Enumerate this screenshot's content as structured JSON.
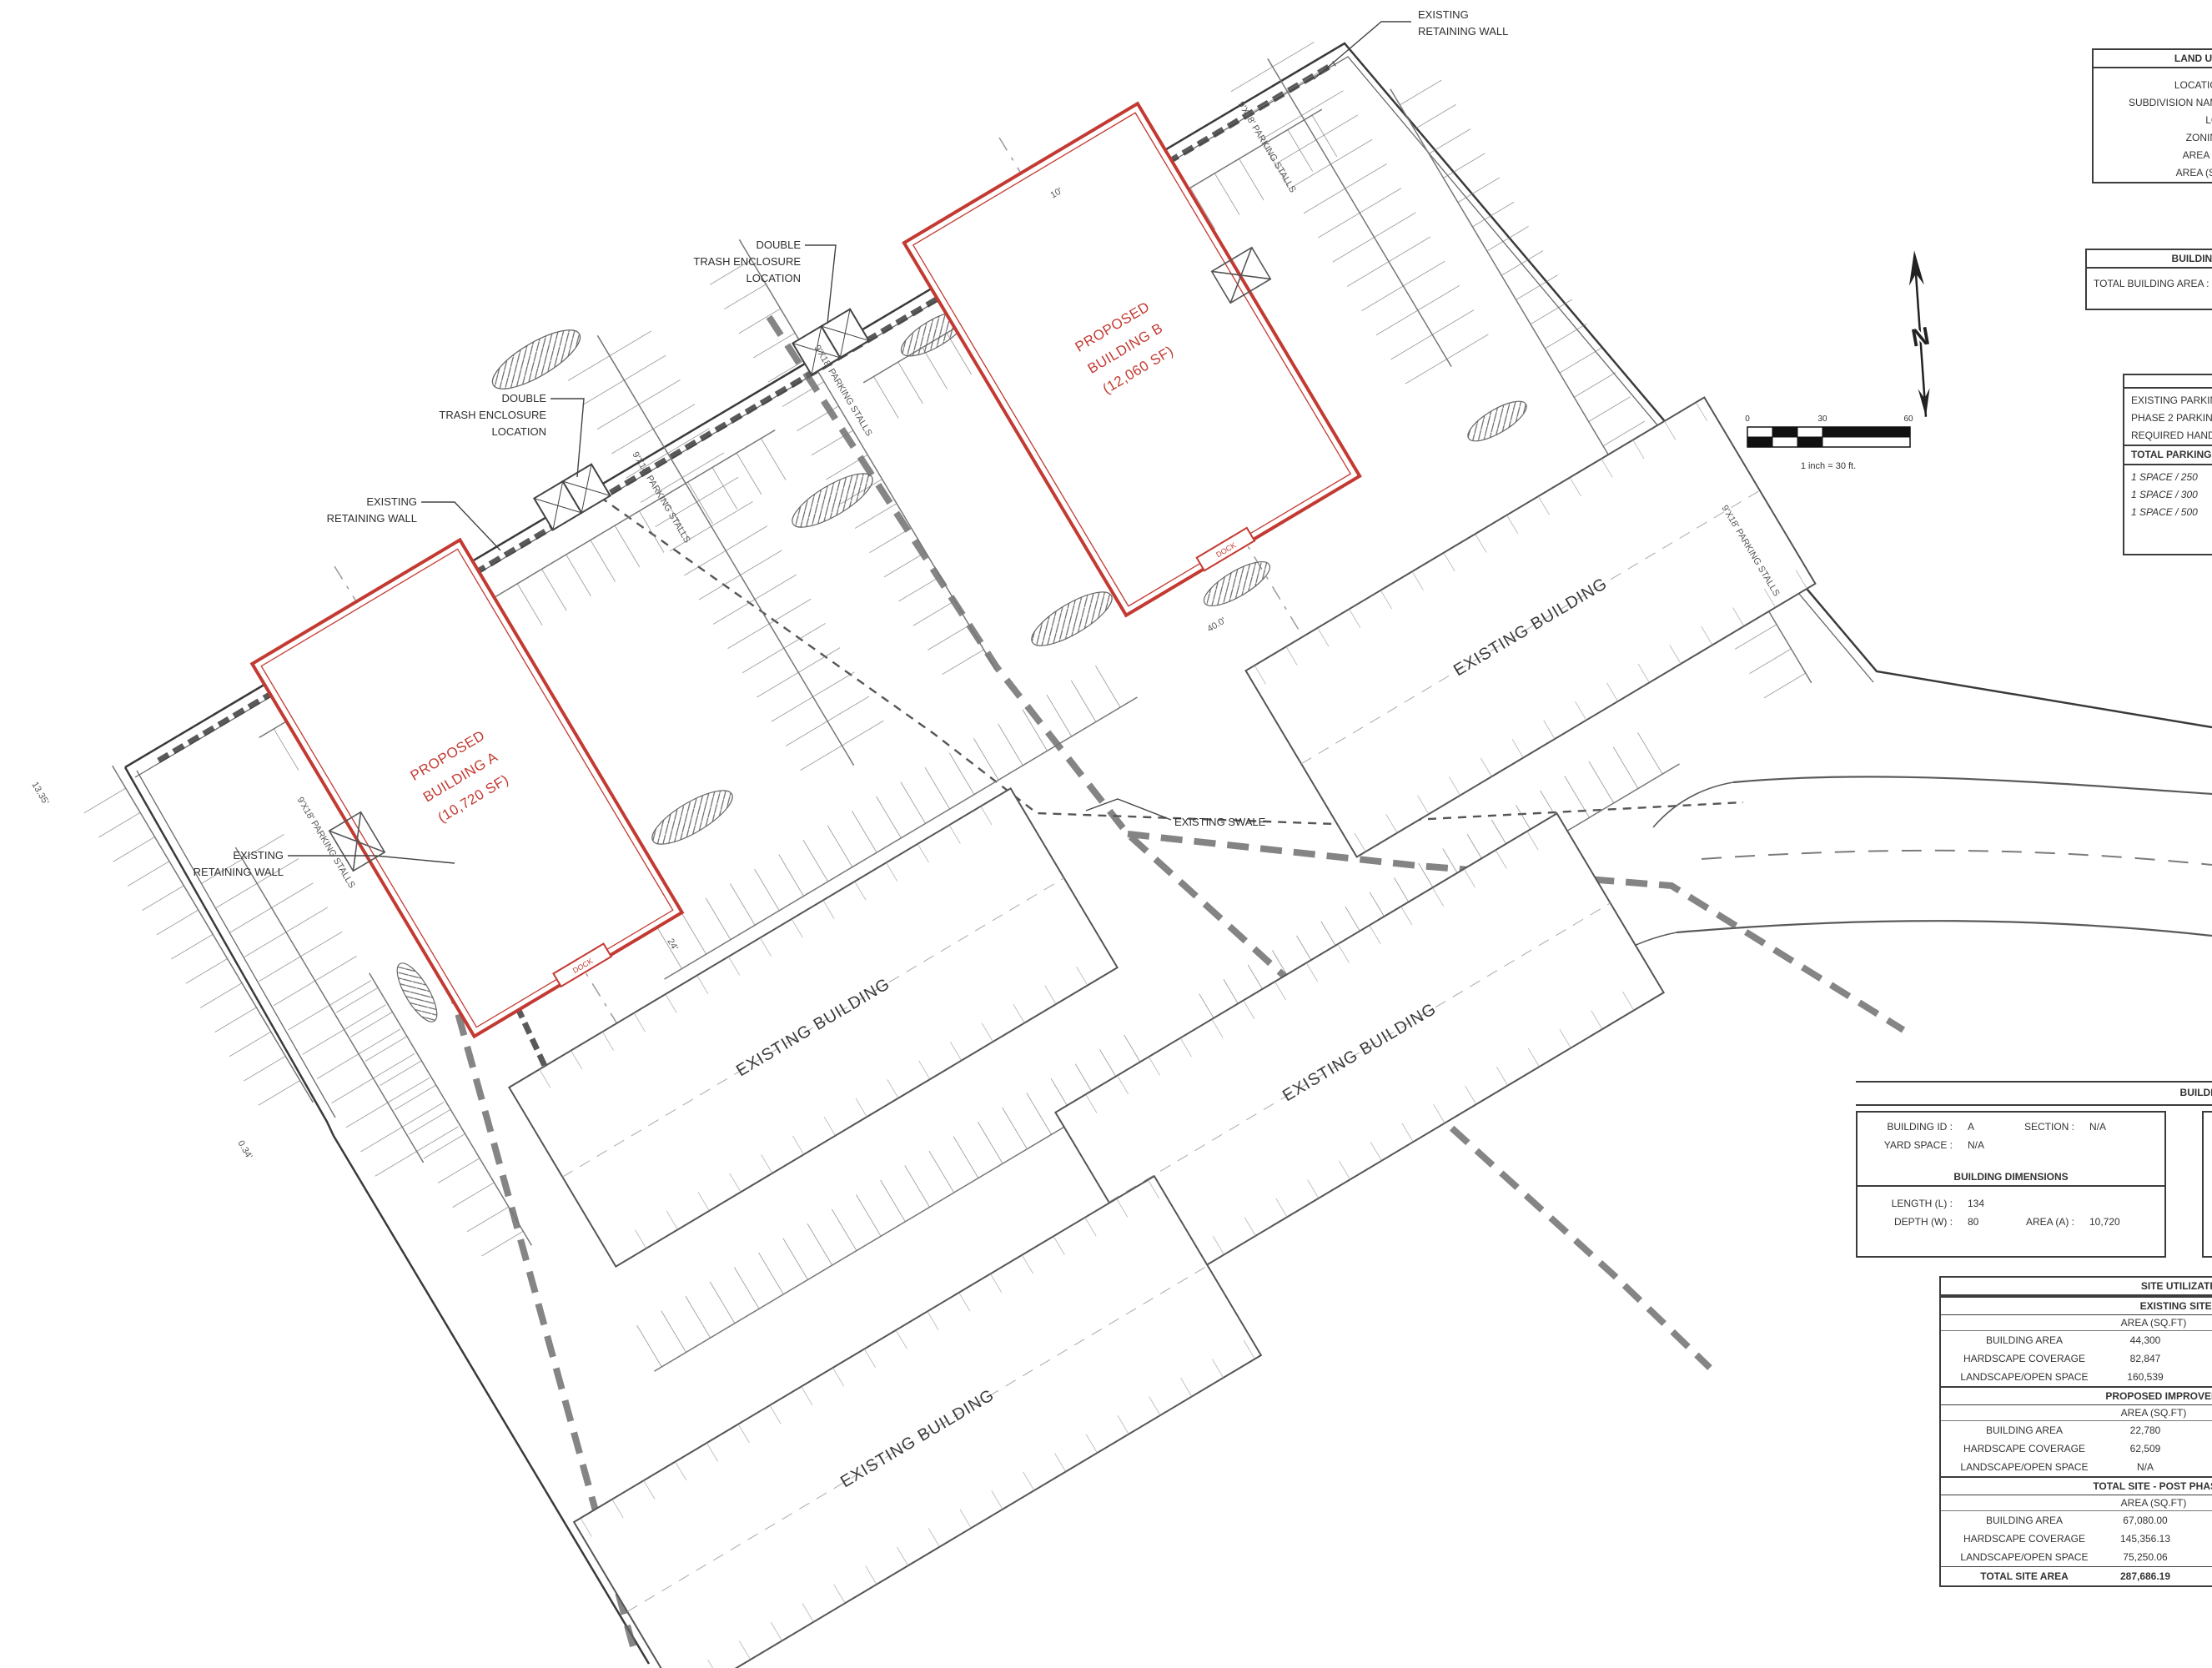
{
  "colors": {
    "red": "#c33a32",
    "ink": "#333333",
    "line": "#5a5a5a"
  },
  "north": {
    "label": "N"
  },
  "scale_bar": {
    "ticks": [
      "0",
      "30",
      "60"
    ],
    "caption": "1 inch = 30 ft."
  },
  "plan": {
    "existing_building": "EXISTING BUILDING",
    "swale": "EXISTING SWALE",
    "retaining_wall_line1": "EXISTING",
    "retaining_wall_line2": "RETAINING WALL",
    "trash_line1": "DOUBLE",
    "trash_line2": "TRASH ENCLOSURE",
    "trash_line3": "LOCATION",
    "building_a_line1": "PROPOSED",
    "building_a_line2": "BUILDING A",
    "building_a_line3": "(10,720 SF)",
    "building_b_line1": "PROPOSED",
    "building_b_line2": "BUILDING B",
    "building_b_line3": "(12,060 SF)",
    "stalls": "9'X18' PARKING STALLS",
    "dock": "DOCK",
    "dims": {
      "d10": "10'",
      "d40": "40.0'",
      "d24": "24'",
      "d1335": "13.35'",
      "d034": "0.34'"
    }
  },
  "tables": {
    "land_use": {
      "header": "LAND USE DATA",
      "rows": [
        "LOCATION :",
        "SUBDIVISION NAME :",
        "LOT :",
        "ZONING :",
        "AREA SF :",
        "AREA (SF) :"
      ]
    },
    "building_areas": {
      "header": "BUILDING AREAS",
      "row": "TOTAL BUILDING AREA :"
    },
    "parking": {
      "header": "PARKING DATA",
      "rows": [
        "EXISTING PARKING",
        "PHASE 2 PARKING",
        "REQUIRED HANDICAP"
      ],
      "total_row": "TOTAL PARKING",
      "ratio_rows": [
        "1 SPACE / 250",
        "1 SPACE / 300",
        "1 SPACE / 500"
      ]
    },
    "building_data": {
      "header": "BUILDING DATA",
      "building_id_label": "BUILDING ID :",
      "building_id": "A",
      "section_label": "SECTION :",
      "section": "N/A",
      "yard_label": "YARD SPACE :",
      "yard": "N/A",
      "dims_header": "BUILDING DIMENSIONS",
      "length_label": "LENGTH (L) :",
      "length": "134",
      "depth_label": "DEPTH (W) :",
      "depth": "80",
      "area_label": "AREA (A) :",
      "area": "10,720"
    },
    "site_utilization": {
      "header": "SITE UTILIZATION TABLE",
      "col_header": "AREA (SQ.FT)",
      "sections": [
        {
          "title": "EXISTING SITE (PHASE 1)",
          "rows": [
            [
              "BUILDING AREA",
              "44,300"
            ],
            [
              "HARDSCAPE COVERAGE",
              "82,847"
            ],
            [
              "LANDSCAPE/OPEN SPACE",
              "160,539"
            ]
          ]
        },
        {
          "title": "PROPOSED IMPROVEMENTS (PHASE 2)",
          "rows": [
            [
              "BUILDING AREA",
              "22,780"
            ],
            [
              "HARDSCAPE COVERAGE",
              "62,509"
            ],
            [
              "LANDSCAPE/OPEN SPACE",
              "N/A"
            ]
          ]
        },
        {
          "title": "TOTAL SITE - POST PHASE 2 DEVELOPMENT",
          "rows": [
            [
              "BUILDING AREA",
              "67,080.00"
            ],
            [
              "HARDSCAPE COVERAGE",
              "145,356.13"
            ],
            [
              "LANDSCAPE/OPEN SPACE",
              "75,250.06"
            ]
          ],
          "total": [
            "TOTAL SITE AREA",
            "287,686.19"
          ]
        }
      ]
    }
  }
}
